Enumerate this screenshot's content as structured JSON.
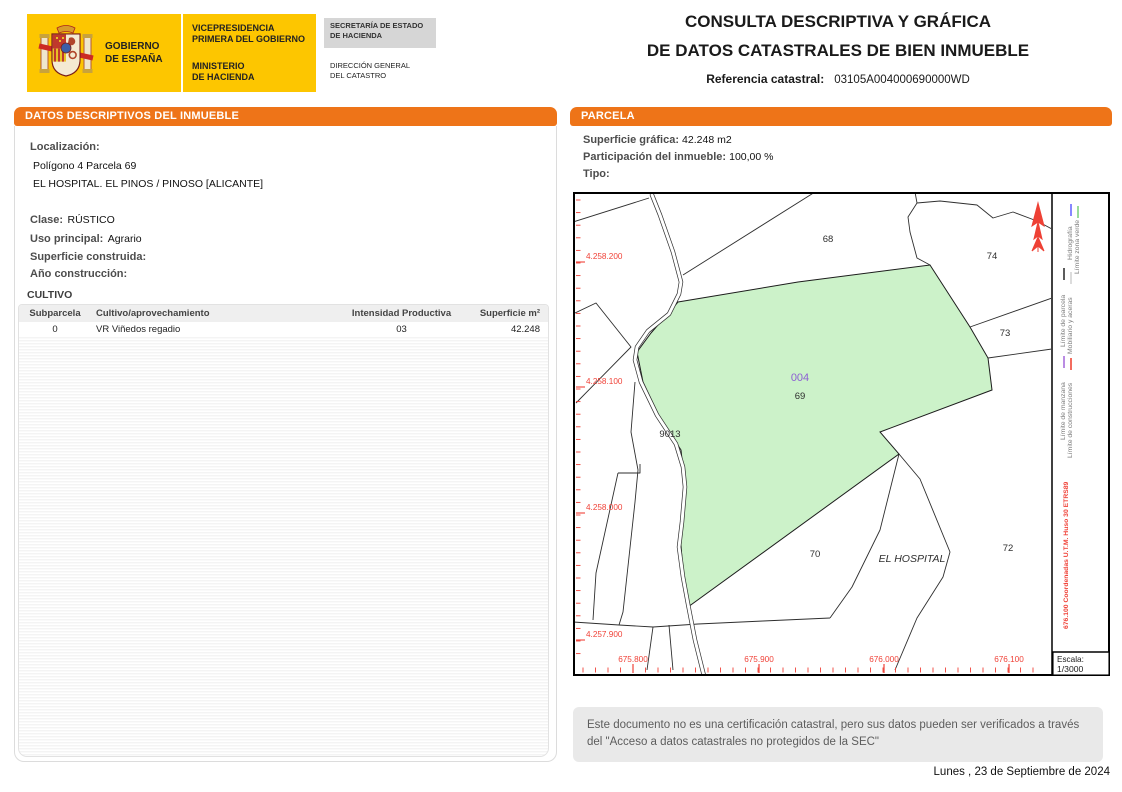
{
  "header": {
    "logo": {
      "gobierno": "GOBIERNO\nDE ESPAÑA",
      "vicepresidencia": "VICEPRESIDENCIA\nPRIMERA DEL GOBIERNO",
      "ministerio": "MINISTERIO\nDE HACIENDA",
      "secretaria": "SECRETARÍA DE ESTADO\nDE HACIENDA",
      "direccion": "DIRECCIÓN GENERAL\nDEL CATASTRO"
    },
    "title_line1": "CONSULTA DESCRIPTIVA Y GRÁFICA",
    "title_line2": "DE DATOS CATASTRALES DE BIEN INMUEBLE",
    "ref_label": "Referencia catastral:",
    "ref_value": "03105A004000690000WD"
  },
  "left_panel": {
    "header": "DATOS DESCRIPTIVOS DEL INMUEBLE",
    "localizacion_label": "Localización:",
    "localizacion_line1": "Polígono 4 Parcela 69",
    "localizacion_line2": "EL HOSPITAL. EL PINOS / PINOSO [ALICANTE]",
    "clase_label": "Clase:",
    "clase_value": "RÚSTICO",
    "uso_label": "Uso principal:",
    "uso_value": "Agrario",
    "superficie_label": "Superficie construida:",
    "superficie_value": "",
    "anio_label": "Año construcción:",
    "anio_value": "",
    "cultivo_title": "CULTIVO",
    "table": {
      "headers": [
        "Subparcela",
        "Cultivo/aprovechamiento",
        "Intensidad Productiva",
        "Superficie m²"
      ],
      "rows": [
        [
          "0",
          "VR Viñedos regadio",
          "03",
          "42.248"
        ]
      ]
    }
  },
  "right_panel": {
    "header": "PARCELA",
    "superficie_label": "Superficie gráfica:",
    "superficie_value": "42.248 m2",
    "participacion_label": "Participación del inmueble:",
    "participacion_value": "100,00 %",
    "tipo_label": "Tipo:",
    "tipo_value": "",
    "map": {
      "parcel_labels": [
        {
          "text": "68",
          "x": 255,
          "y": 50
        },
        {
          "text": "74",
          "x": 419,
          "y": 67
        },
        {
          "text": "73",
          "x": 432,
          "y": 144
        },
        {
          "text": "004",
          "x": 227,
          "y": 189,
          "color": "#8d5fd3",
          "size": 11
        },
        {
          "text": "69",
          "x": 227,
          "y": 207
        },
        {
          "text": "9013",
          "x": 97,
          "y": 245
        },
        {
          "text": "70",
          "x": 242,
          "y": 365
        },
        {
          "text": "EL HOSPITAL",
          "x": 339,
          "y": 370,
          "italic": true,
          "size": 10.5
        },
        {
          "text": "72",
          "x": 435,
          "y": 359
        }
      ],
      "y_axis": [
        {
          "text": "4.258.200",
          "y": 67
        },
        {
          "text": "4.258.100",
          "y": 192
        },
        {
          "text": "4.258.000",
          "y": 318
        },
        {
          "text": "4.257.900",
          "y": 445
        }
      ],
      "x_axis": [
        {
          "text": "675.800",
          "x": 60
        },
        {
          "text": "675.900",
          "x": 186
        },
        {
          "text": "676.000",
          "x": 311
        },
        {
          "text": "676.100",
          "x": 436
        }
      ],
      "legend": [
        {
          "label": "Límite de parcela",
          "color": "#4a4a4a"
        },
        {
          "label": "Hidrografía",
          "color": "#7a7aff"
        },
        {
          "label": "Límite zona verde",
          "color": "#8ed88e"
        },
        {
          "label": "Mobiliario y aceras",
          "color": "#d9d9d9"
        },
        {
          "label": "Límite de manzana",
          "color": "#b27fe0"
        },
        {
          "label": "Límite de construcciones",
          "color": "#f25c4d"
        }
      ],
      "utm_note": "676.100 Coordenadas U.T.M. Huso 30 ETRS89",
      "escala_label": "Escala:",
      "escala_value": "1/3000"
    },
    "footer_note": "Este documento no es una certificación catastral, pero sus datos pueden ser verificados a través del \"Acceso a datos catastrales no protegidos de la SEC\"",
    "date": "Lunes , 23 de Septiembre de 2024"
  },
  "colors": {
    "orange": "#ee7418",
    "yellow": "#fdc600",
    "parcel_green": "#ccf2c9",
    "map_red": "#f04238",
    "purple_label": "#8d5fd3"
  }
}
